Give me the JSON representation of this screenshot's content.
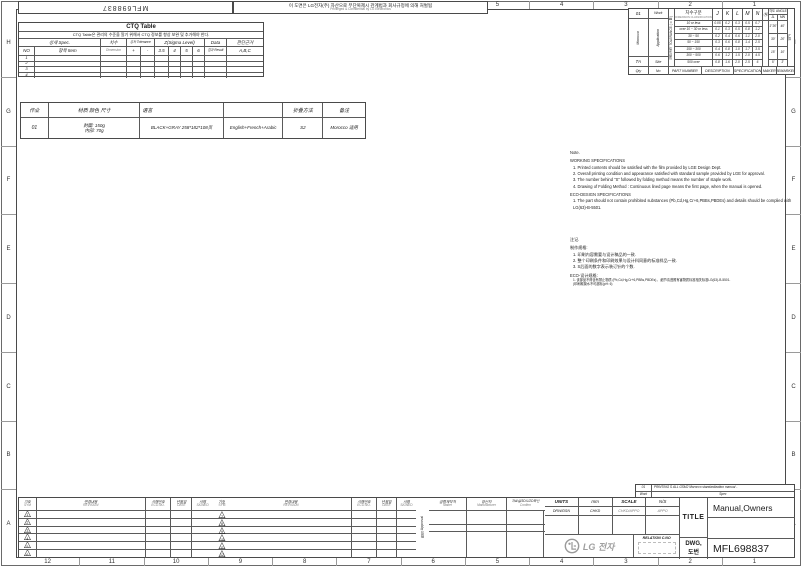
{
  "doc": {
    "number": "MFL698837",
    "title": "Manual,Owners"
  },
  "margins": {
    "columns": [
      "12",
      "11",
      "10",
      "9",
      "8",
      "7",
      "6",
      "5",
      "4",
      "3",
      "2",
      "1"
    ],
    "rows": [
      "H",
      "G",
      "F",
      "E",
      "D",
      "C",
      "B",
      "A"
    ]
  },
  "stamp": {
    "ko": "이 도면은 LG전자(주) 자산으로 무단복제시 관계법과 회사규정에 의해 처벌됨",
    "en": "Privileged & Confidential by LG Electronics"
  },
  "ctq": {
    "title": "CTQ Table",
    "note": "CTQ Table은 관리의 수준을 알기 위해서 CTQ 정보를 항상 보완 및 추가해야 한다.",
    "spec_group": "상세 Spec.",
    "no": "NO",
    "item": "항목 Item",
    "dim": "치수",
    "dim_sub": "Dimension",
    "tol": "공차 Tolerance",
    "tol_plus": "+",
    "tol_minus": "-",
    "sigma": "Z(Sigma Level)",
    "sigma_cols": [
      "3.5",
      "4",
      "5",
      "6"
    ],
    "data": "Data",
    "result": "결과 Result",
    "reason": "판단근거",
    "reason_sub": "Reason",
    "reason_vals": "A,B,C",
    "row_numbers": [
      "1",
      "2",
      "3",
      "4"
    ]
  },
  "spec": {
    "h_work": "作业",
    "h_material": "材质  颜色  尺寸",
    "h_language": "语言",
    "h_fold": "折叠方法",
    "h_remark": "备注",
    "work": "01",
    "material_1": "封面: 150g",
    "material_2": "内部: 70g",
    "color_size": "BLACK+GRAY 258*182*108页",
    "language": "English+French+Arabic",
    "fold": "S2",
    "remark": "Morocco 适用"
  },
  "tolerance": {
    "side_label": "일반공차 TOLERANCE (±㎜)",
    "header_ko": "치수구분",
    "header_en": "DIMENSION CLASSIFICATION",
    "classes": [
      "J",
      "K",
      "L",
      "M",
      "N",
      "Ⓝ"
    ],
    "angle_title_ko": "각도",
    "angle_title_en": "ANGLE",
    "angle_sub": [
      "JL",
      "MN"
    ],
    "remark_label": "비고",
    "rows": [
      {
        "range": "10 or less",
        "v": [
          "0.05",
          "0.2",
          "0.3",
          "0.5",
          "0.7"
        ]
      },
      {
        "range": "over 10 ~ 30 or less",
        "v": [
          "0.1",
          "0.3",
          "0.5",
          "0.8",
          "1.2"
        ]
      },
      {
        "range": "30 ~ 50",
        "v": [
          "0.2",
          "0.4",
          "0.6",
          "1.1",
          "2.0"
        ]
      },
      {
        "range": "50 ~ 150",
        "v": [
          "0.3",
          "0.6",
          "0.8",
          "1.4",
          "2.5"
        ]
      },
      {
        "range": "150 ~ 300",
        "v": [
          "0.4",
          "0.8",
          "1.0",
          "1.7",
          "3.5"
        ]
      },
      {
        "range": "300 ~ 500",
        "v": [
          "0.6",
          "1.2",
          "1.5",
          "2.0",
          "4.5"
        ]
      },
      {
        "range": "500 over",
        "v": [
          "0.8",
          "1.6",
          "2.0",
          "2.5",
          "6"
        ]
      }
    ],
    "angles": [
      {
        "jl": "1°30'",
        "mn": "40'"
      },
      {
        "jl": "30'",
        "mn": "20'"
      },
      {
        "jl": "15'",
        "mn": "10'"
      },
      {
        "jl": "5'",
        "mn": "3'"
      }
    ]
  },
  "apply": {
    "rows": [
      {
        "val": "01",
        "label": "Work"
      },
      {
        "val": "Morocco",
        "label": "Application"
      },
      {
        "val": "TA",
        "label": "Site"
      }
    ],
    "qty": "Qty",
    "no": "No",
    "part_headers": [
      "PART NUMBER",
      "DESCRIPTION",
      "SPECIFICATION",
      "MAKER",
      "REMARKER"
    ]
  },
  "notes": {
    "en_title": "Note.",
    "en_sec1_title": "WORKING SPECIFICATIONS",
    "en_sec1": [
      "1. Printed contents should be satisfied with the film provided by LGE Design Dept.",
      "2. Overall printing condition and appearance satisfied with standard sample provided by LGE for approval.",
      "3. The number behind \"S\" followed by folding method means the number of   staple work.",
      "4. Drawing of Folding Method : Continuous lined page means the first page, when   the manual is opened."
    ],
    "en_sec2_title": "ECO-DESIGN SPECIFICATIONS",
    "en_sec2": [
      "1.  The part should not contain prohibited substances (Pb,Cd,Hg,Cr+6,PBBs,PBDEs)    and details should be complied with LG(63)-B-5501."
    ],
    "cn_title": "注记.",
    "cn_sec1_title": "制作规格:",
    "cn_sec1": [
      "1.  印刷内容需要与设计稿品的一致.",
      "2.  整个印刷条件和印刷效果与设计科同意的标准样品一致.",
      "3.  S后面的数字表示装订针的个数."
    ],
    "cn_sec2_title": "ECO-设计规格:",
    "cn_sec2": [
      "1.  该部品不得含有禁止物质 (Pb,Cd,Hg,Cr+6,PBBs,PBDEs)，  细节请遵照有害物质标准相关标准LG(63)-B-5501.",
      "     (印刷覆膜水不可超标(pH: 6)"
    ]
  },
  "revision": {
    "sym_ko": "기호",
    "sym_en": "SYM",
    "rev_ko": "변경내용",
    "rev_en": "REVISION",
    "eco_ko": "시행번호",
    "eco_en": "ECO.NO.",
    "date_ko": "년월일",
    "date_en": "DATE",
    "sign_ko": "서명",
    "sign_en": "SIGNED",
    "approval": "합의 Approval",
    "maker_ko": "금형제작처",
    "maker_en": "Maker",
    "manuf_ko": "양산처",
    "manuf_en": "Manufacturer",
    "confirm_ko": "자료실/3D도/2D확인",
    "confirm_en": "Confirm",
    "left_syms": [
      "1",
      "2",
      "3",
      "4",
      "5",
      "6"
    ],
    "right_syms": [
      "7",
      "8",
      "9",
      "10",
      "11",
      "12"
    ]
  },
  "titleblock": {
    "work_num": "01",
    "work_text": "PRINTING S ALL GSM2 Morocco standardization manual -",
    "work_label": "Work",
    "spec_label": "Spec",
    "units_label": "UNITS",
    "units_value": "mm",
    "scale_label": "SCALE",
    "scale_value": "N/S",
    "drw": "DRW/DSN",
    "chkd": "CHKD",
    "chkd_appo": "CHKD/APPO",
    "appo": "APPO",
    "relation_label": "RELATION C.NO",
    "title_label": "TITLE",
    "title_value": "Manual,Owners",
    "dwg_label1": "DWG,",
    "dwg_label2": "도번",
    "dwg_value": "MFL698837",
    "logo_text": "LG 전자"
  }
}
